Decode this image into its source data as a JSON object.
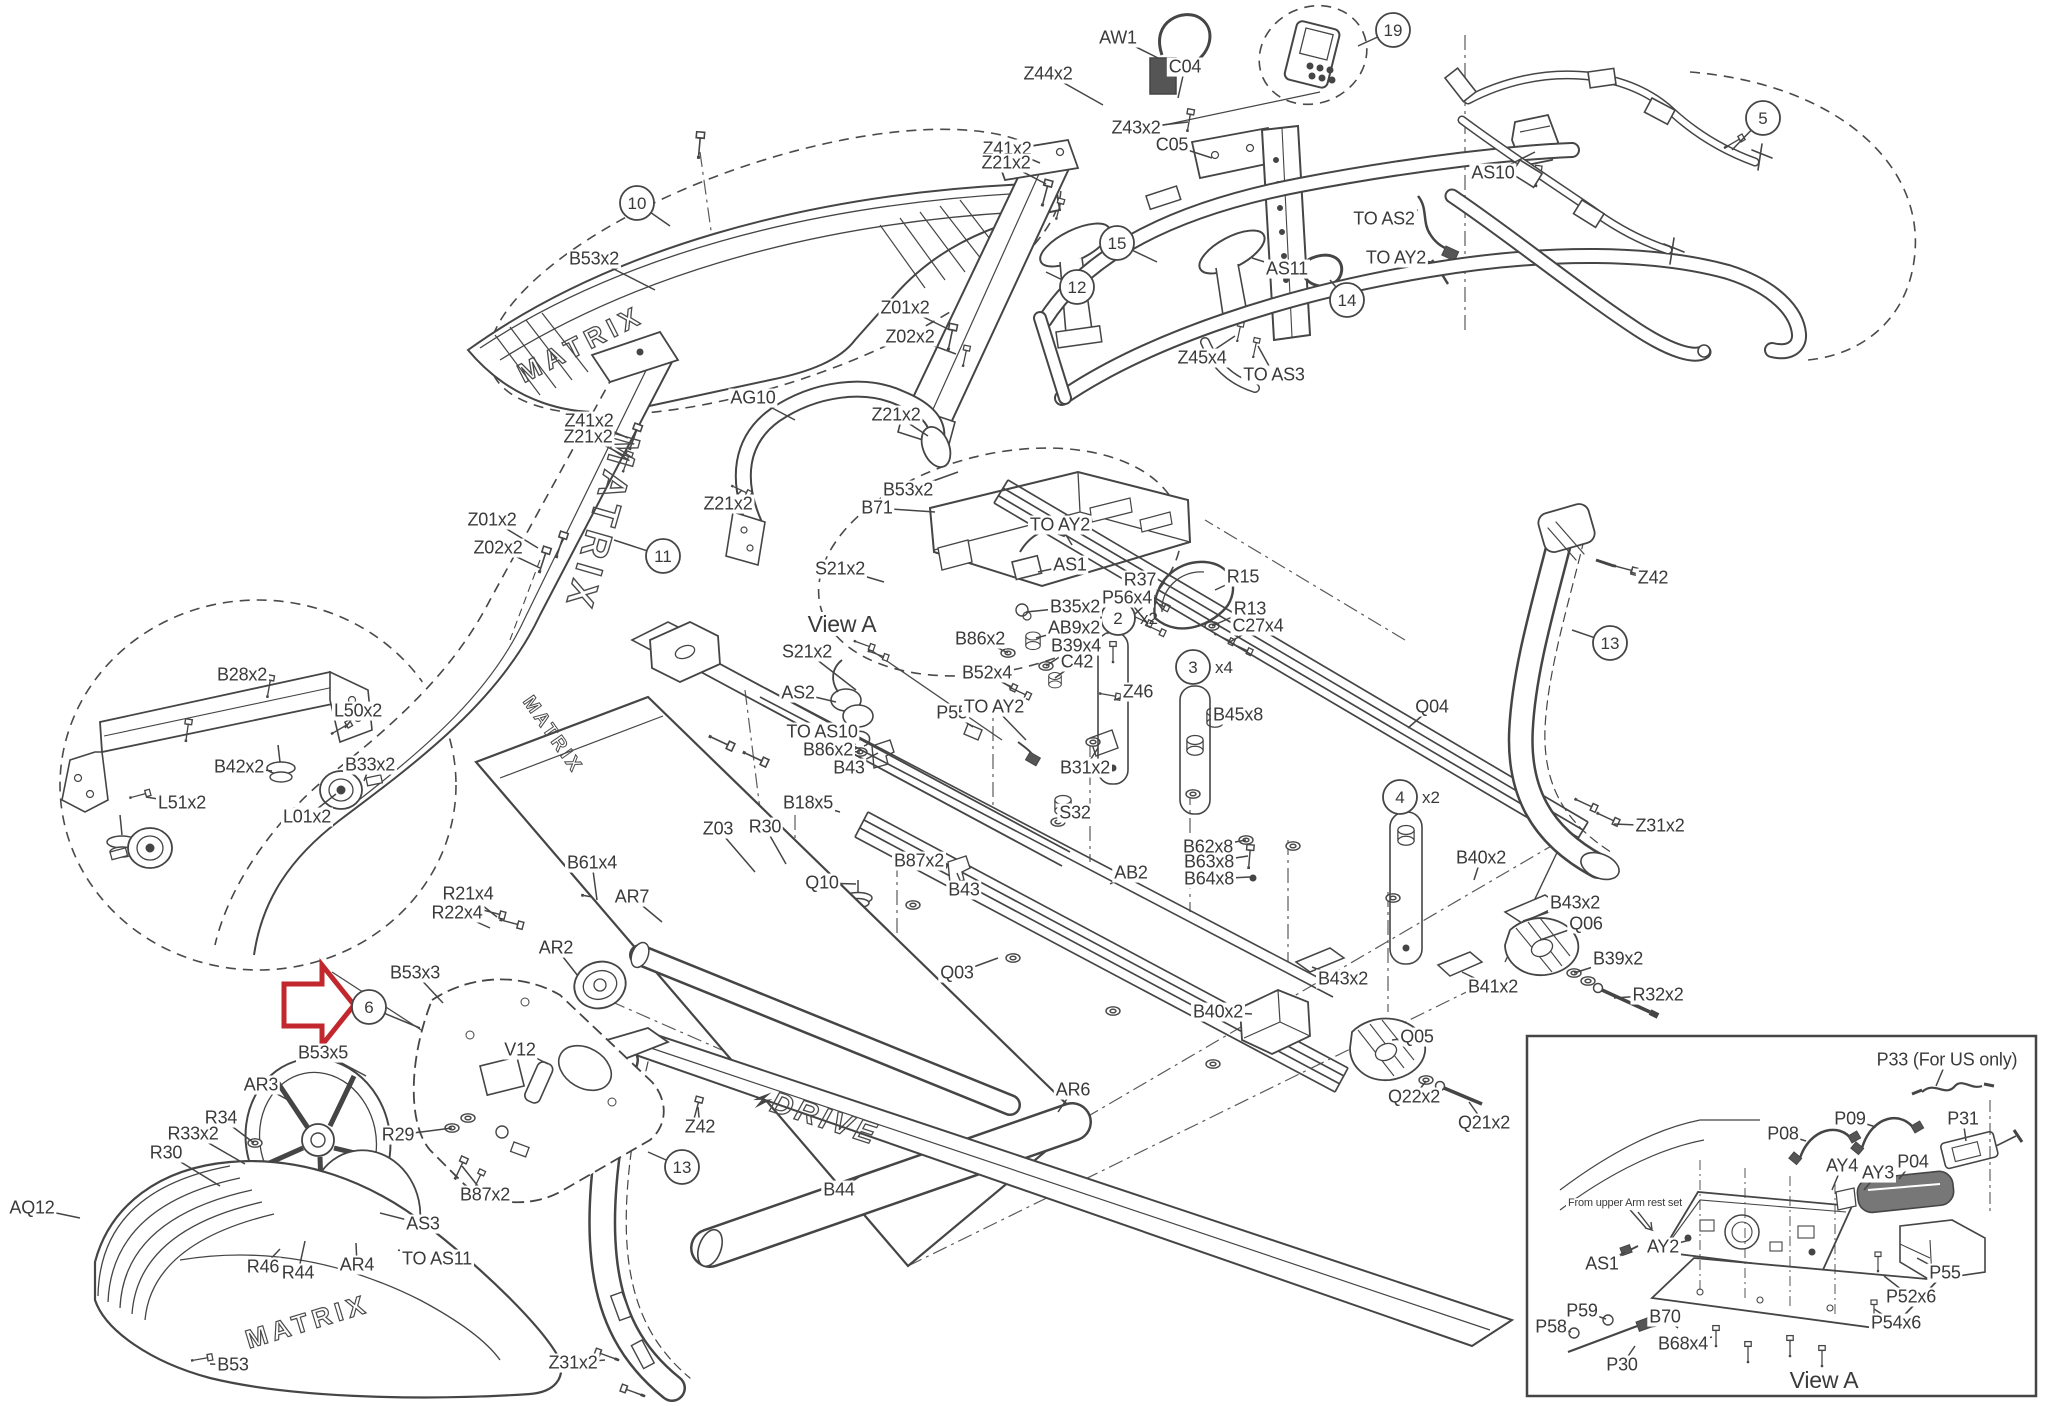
{
  "meta": {
    "page_type": "exploded-parts-diagram",
    "background": "#ffffff",
    "line_color": "#454545",
    "label_color": "#3a3a3a",
    "label_font_px": 18
  },
  "logos": {
    "brand": "MATRIX",
    "drive": "DRIVE"
  },
  "arrow": {
    "color": "#c1272d",
    "points_at_callout": "6"
  },
  "inset": {
    "title": "View A"
  },
  "labels": [
    {
      "t": "AW1",
      "x": 1118,
      "y": 38,
      "l": [
        1158,
        58
      ]
    },
    {
      "t": "C04",
      "x": 1185,
      "y": 67,
      "l": [
        1178,
        98
      ]
    },
    {
      "t": "Z44x2",
      "x": 1048,
      "y": 74,
      "l": [
        1103,
        105
      ]
    },
    {
      "t": "Z43x2",
      "x": 1136,
      "y": 128,
      "l": [
        1188,
        122
      ]
    },
    {
      "t": "C05",
      "x": 1172,
      "y": 145,
      "l": [
        1212,
        158
      ]
    },
    {
      "t": "AS10",
      "x": 1493,
      "y": 173,
      "l": [
        1535,
        152
      ]
    },
    {
      "t": "TO AS2",
      "x": 1384,
      "y": 219,
      "l": [
        1418,
        210
      ]
    },
    {
      "t": "TO AY2",
      "x": 1396,
      "y": 258,
      "l": [
        1432,
        262
      ]
    },
    {
      "t": "AS11",
      "x": 1287,
      "y": 269,
      "l": [
        1252,
        258
      ]
    },
    {
      "t": "Z45x4",
      "x": 1202,
      "y": 358,
      "l": [
        1235,
        336
      ]
    },
    {
      "t": "TO AS3",
      "x": 1274,
      "y": 375,
      "l": [
        1258,
        346
      ]
    },
    {
      "t": "B53x2",
      "x": 594,
      "y": 259,
      "l": [
        655,
        290
      ]
    },
    {
      "t": "Z41x2",
      "x": 1007,
      "y": 149,
      "l": [
        1040,
        163
      ]
    },
    {
      "t": "Z21x2",
      "x": 1006,
      "y": 163,
      "l": [
        1046,
        184
      ]
    },
    {
      "t": "Z01x2",
      "x": 905,
      "y": 308,
      "l": [
        950,
        330
      ]
    },
    {
      "t": "Z02x2",
      "x": 910,
      "y": 337,
      "l": [
        956,
        354
      ]
    },
    {
      "t": "AG10",
      "x": 753,
      "y": 398,
      "l": [
        795,
        420
      ]
    },
    {
      "t": "Z21x2",
      "x": 896,
      "y": 415,
      "l": [
        928,
        436
      ]
    },
    {
      "t": "Z41x2",
      "x": 589,
      "y": 421,
      "l": [
        628,
        438
      ]
    },
    {
      "t": "Z21x2",
      "x": 588,
      "y": 437,
      "l": [
        625,
        456
      ]
    },
    {
      "t": "Z21x2",
      "x": 728,
      "y": 504,
      "l": [
        742,
        490
      ]
    },
    {
      "t": "Z01x2",
      "x": 492,
      "y": 520,
      "l": [
        538,
        548
      ]
    },
    {
      "t": "Z02x2",
      "x": 498,
      "y": 548,
      "l": [
        540,
        568
      ]
    },
    {
      "t": "B53x2",
      "x": 908,
      "y": 490,
      "l": [
        958,
        472
      ]
    },
    {
      "t": "B71",
      "x": 877,
      "y": 508,
      "l": [
        935,
        512
      ]
    },
    {
      "t": "S21x2",
      "x": 840,
      "y": 569,
      "l": [
        884,
        582
      ]
    },
    {
      "t": "View A",
      "x": 842,
      "y": 624,
      "s": 23
    },
    {
      "t": "S21x2",
      "x": 807,
      "y": 652,
      "l": [
        856,
        690
      ]
    },
    {
      "t": "B86x2",
      "x": 980,
      "y": 639,
      "l": [
        1008,
        653
      ]
    },
    {
      "t": "B52x4",
      "x": 987,
      "y": 673,
      "l": [
        1012,
        688
      ]
    },
    {
      "t": "TO AY2",
      "x": 1060,
      "y": 525,
      "l": [
        1072,
        545
      ]
    },
    {
      "t": "AS1",
      "x": 1070,
      "y": 565,
      "l": [
        1038,
        572
      ]
    },
    {
      "t": "B35x2",
      "x": 1075,
      "y": 607,
      "l": [
        1026,
        612
      ]
    },
    {
      "t": "AB9x2",
      "x": 1074,
      "y": 628,
      "l": [
        1036,
        638
      ]
    },
    {
      "t": "B39x4",
      "x": 1076,
      "y": 646,
      "l": [
        1046,
        666
      ]
    },
    {
      "t": "C42",
      "x": 1077,
      "y": 662,
      "l": [
        1055,
        678
      ]
    },
    {
      "t": "R37",
      "x": 1140,
      "y": 580,
      "l": [
        1163,
        610
      ]
    },
    {
      "t": "R15",
      "x": 1243,
      "y": 577,
      "l": [
        1215,
        590
      ]
    },
    {
      "t": "P56x4",
      "x": 1127,
      "y": 598,
      "l": [
        1148,
        624
      ]
    },
    {
      "t": "R13",
      "x": 1250,
      "y": 609,
      "l": [
        1212,
        626
      ]
    },
    {
      "t": "C27x4",
      "x": 1258,
      "y": 626,
      "l": [
        1228,
        643
      ]
    },
    {
      "t": "Z46",
      "x": 1138,
      "y": 692,
      "l": [
        1114,
        700
      ]
    },
    {
      "t": "P55",
      "x": 952,
      "y": 713,
      "l": [
        973,
        727
      ]
    },
    {
      "t": "TO AY2",
      "x": 994,
      "y": 707,
      "l": [
        1026,
        740
      ]
    },
    {
      "t": "B45x8",
      "x": 1238,
      "y": 715,
      "l": [
        1215,
        719
      ]
    },
    {
      "t": "B31x2",
      "x": 1085,
      "y": 768,
      "l": [
        1098,
        748
      ]
    },
    {
      "t": "S32",
      "x": 1075,
      "y": 813,
      "l": [
        1058,
        822
      ]
    },
    {
      "t": "B18x5",
      "x": 808,
      "y": 803,
      "l": [
        840,
        812
      ]
    },
    {
      "t": "AS2",
      "x": 798,
      "y": 693,
      "l": [
        836,
        702
      ]
    },
    {
      "t": "TO AS10",
      "x": 822,
      "y": 732,
      "l": [
        860,
        740
      ]
    },
    {
      "t": "B86x2",
      "x": 828,
      "y": 750,
      "l": [
        860,
        752
      ]
    },
    {
      "t": "B43",
      "x": 849,
      "y": 768,
      "l": [
        878,
        753
      ]
    },
    {
      "t": "Z03",
      "x": 718,
      "y": 829,
      "l": [
        755,
        872
      ]
    },
    {
      "t": "R30",
      "x": 765,
      "y": 827,
      "l": [
        786,
        864
      ]
    },
    {
      "t": "B61x4",
      "x": 592,
      "y": 863,
      "l": [
        597,
        900
      ]
    },
    {
      "t": "AR7",
      "x": 632,
      "y": 897,
      "l": [
        662,
        922
      ]
    },
    {
      "t": "R21x4",
      "x": 468,
      "y": 894,
      "l": [
        497,
        917
      ]
    },
    {
      "t": "R22x4",
      "x": 457,
      "y": 913,
      "l": [
        490,
        928
      ]
    },
    {
      "t": "Q10",
      "x": 822,
      "y": 883,
      "l": [
        856,
        884
      ]
    },
    {
      "t": "B87x2",
      "x": 919,
      "y": 861,
      "l": [
        940,
        867
      ]
    },
    {
      "t": "B43",
      "x": 964,
      "y": 890,
      "l": [
        957,
        873
      ]
    },
    {
      "t": "AB2",
      "x": 1131,
      "y": 873,
      "l": [
        1110,
        884
      ]
    },
    {
      "t": "B62x8",
      "x": 1208,
      "y": 847,
      "l": [
        1246,
        840
      ]
    },
    {
      "t": "B63x8",
      "x": 1209,
      "y": 862,
      "l": [
        1248,
        856
      ]
    },
    {
      "t": "B64x8",
      "x": 1209,
      "y": 879,
      "l": [
        1250,
        877
      ]
    },
    {
      "t": "Q03",
      "x": 957,
      "y": 973,
      "l": [
        998,
        958
      ]
    },
    {
      "t": "B40x2",
      "x": 1218,
      "y": 1012,
      "l": [
        1252,
        1014
      ]
    },
    {
      "t": "AR6",
      "x": 1073,
      "y": 1090,
      "l": [
        1058,
        1112
      ]
    },
    {
      "t": "Q05",
      "x": 1417,
      "y": 1037,
      "l": [
        1392,
        1040
      ]
    },
    {
      "t": "Q22x2",
      "x": 1414,
      "y": 1097,
      "l": [
        1426,
        1081
      ]
    },
    {
      "t": "Q21x2",
      "x": 1484,
      "y": 1123,
      "l": [
        1469,
        1102
      ]
    },
    {
      "t": "Z31x2",
      "x": 1660,
      "y": 826,
      "l": [
        1614,
        824
      ]
    },
    {
      "t": "B40x2",
      "x": 1481,
      "y": 858,
      "l": [
        1474,
        880
      ]
    },
    {
      "t": "B43x2",
      "x": 1575,
      "y": 903,
      "l": [
        1523,
        921
      ]
    },
    {
      "t": "Q06",
      "x": 1586,
      "y": 924,
      "l": [
        1540,
        940
      ]
    },
    {
      "t": "B39x2",
      "x": 1618,
      "y": 959,
      "l": [
        1574,
        973
      ]
    },
    {
      "t": "R32x2",
      "x": 1658,
      "y": 995,
      "l": [
        1614,
        998
      ]
    },
    {
      "t": "B41x2",
      "x": 1493,
      "y": 987,
      "l": [
        1462,
        972
      ]
    },
    {
      "t": "B43x2",
      "x": 1343,
      "y": 979,
      "l": [
        1312,
        967
      ]
    },
    {
      "t": "Q04",
      "x": 1432,
      "y": 707,
      "l": [
        1408,
        728
      ]
    },
    {
      "t": "Z42",
      "x": 1653,
      "y": 578,
      "l": [
        1630,
        572
      ]
    },
    {
      "t": "Z42",
      "x": 700,
      "y": 1127,
      "l": [
        698,
        1107
      ]
    },
    {
      "t": "B44",
      "x": 839,
      "y": 1190,
      "l": [
        862,
        1175
      ]
    },
    {
      "t": "Z31x2",
      "x": 573,
      "y": 1363,
      "l": [
        605,
        1360
      ]
    },
    {
      "t": "AR2",
      "x": 556,
      "y": 948,
      "l": [
        578,
        976
      ]
    },
    {
      "t": "B53x3",
      "x": 415,
      "y": 973,
      "l": [
        443,
        1003
      ]
    },
    {
      "t": "B53x5",
      "x": 323,
      "y": 1053,
      "l": [
        366,
        1076
      ]
    },
    {
      "t": "V12",
      "x": 520,
      "y": 1050,
      "l": [
        548,
        1064
      ]
    },
    {
      "t": "R29",
      "x": 398,
      "y": 1135,
      "l": [
        452,
        1128
      ]
    },
    {
      "t": "B87x2",
      "x": 485,
      "y": 1195,
      "l": [
        462,
        1166
      ]
    },
    {
      "t": "AR3",
      "x": 261,
      "y": 1085,
      "l": [
        288,
        1100
      ]
    },
    {
      "t": "R34",
      "x": 221,
      "y": 1118,
      "l": [
        254,
        1143
      ]
    },
    {
      "t": "R33x2",
      "x": 193,
      "y": 1134,
      "l": [
        245,
        1164
      ]
    },
    {
      "t": "R30",
      "x": 166,
      "y": 1153,
      "l": [
        220,
        1186
      ]
    },
    {
      "t": "AQ12",
      "x": 32,
      "y": 1208,
      "l": [
        80,
        1218
      ]
    },
    {
      "t": "R46",
      "x": 263,
      "y": 1267,
      "l": [
        280,
        1249
      ]
    },
    {
      "t": "R44",
      "x": 298,
      "y": 1273,
      "l": [
        305,
        1241
      ]
    },
    {
      "t": "AR4",
      "x": 357,
      "y": 1265,
      "l": [
        356,
        1243
      ]
    },
    {
      "t": "AS3",
      "x": 423,
      "y": 1224,
      "l": [
        380,
        1213
      ]
    },
    {
      "t": "TO AS11",
      "x": 437,
      "y": 1259,
      "l": [
        398,
        1250
      ]
    },
    {
      "t": "B53",
      "x": 233,
      "y": 1365,
      "l": [
        210,
        1364
      ]
    },
    {
      "t": "B28x2",
      "x": 242,
      "y": 675,
      "l": [
        270,
        685
      ]
    },
    {
      "t": "L50x2",
      "x": 358,
      "y": 711,
      "l": [
        345,
        728
      ]
    },
    {
      "t": "B42x2",
      "x": 239,
      "y": 767,
      "l": [
        272,
        771
      ]
    },
    {
      "t": "B33x2",
      "x": 370,
      "y": 765,
      "l": [
        364,
        781
      ]
    },
    {
      "t": "L51x2",
      "x": 182,
      "y": 803,
      "l": [
        146,
        797
      ]
    },
    {
      "t": "L01x2",
      "x": 307,
      "y": 817,
      "l": [
        336,
        794
      ]
    },
    {
      "t": "P33 (For US only)",
      "x": 1947,
      "y": 1060,
      "l": [
        1936,
        1086
      ]
    },
    {
      "t": "P09",
      "x": 1850,
      "y": 1119,
      "l": [
        1876,
        1127
      ]
    },
    {
      "t": "P08",
      "x": 1783,
      "y": 1134,
      "l": [
        1806,
        1141
      ]
    },
    {
      "t": "P31",
      "x": 1963,
      "y": 1119,
      "l": [
        1966,
        1141
      ]
    },
    {
      "t": "P04",
      "x": 1913,
      "y": 1162,
      "l": [
        1899,
        1179
      ]
    },
    {
      "t": "AY4",
      "x": 1842,
      "y": 1166,
      "l": [
        1832,
        1190
      ]
    },
    {
      "t": "AY3",
      "x": 1878,
      "y": 1173,
      "l": [
        1864,
        1190
      ]
    },
    {
      "t": "From upper Arm rest set",
      "x": 1625,
      "y": 1204,
      "s": 11,
      "l": [
        1646,
        1228
      ]
    },
    {
      "t": "AY2",
      "x": 1663,
      "y": 1247,
      "l": [
        1690,
        1240
      ]
    },
    {
      "t": "AS1",
      "x": 1602,
      "y": 1264,
      "l": [
        1625,
        1252
      ]
    },
    {
      "t": "P55",
      "x": 1945,
      "y": 1273,
      "l": [
        1917,
        1258
      ]
    },
    {
      "t": "P52x6",
      "x": 1911,
      "y": 1297,
      "l": [
        1884,
        1276
      ]
    },
    {
      "t": "P54x6",
      "x": 1896,
      "y": 1323,
      "l": [
        1874,
        1309
      ]
    },
    {
      "t": "P59",
      "x": 1582,
      "y": 1311,
      "l": [
        1606,
        1319
      ]
    },
    {
      "t": "P58",
      "x": 1551,
      "y": 1327,
      "l": [
        1571,
        1332
      ]
    },
    {
      "t": "B70",
      "x": 1665,
      "y": 1317,
      "l": [
        1678,
        1328
      ]
    },
    {
      "t": "B68x4",
      "x": 1683,
      "y": 1344,
      "l": [
        1712,
        1337
      ]
    },
    {
      "t": "P30",
      "x": 1622,
      "y": 1365,
      "l": [
        1635,
        1346
      ]
    },
    {
      "t": "View A",
      "x": 1824,
      "y": 1380,
      "s": 23
    }
  ],
  "callouts": [
    {
      "n": "10",
      "x": 637,
      "y": 203,
      "l": [
        670,
        226
      ]
    },
    {
      "n": "11",
      "x": 663,
      "y": 556,
      "l": [
        614,
        540
      ]
    },
    {
      "n": "12",
      "x": 1077,
      "y": 287,
      "l": [
        1046,
        272
      ]
    },
    {
      "n": "19",
      "x": 1393,
      "y": 30,
      "l": [
        1358,
        46
      ]
    },
    {
      "n": "15",
      "x": 1117,
      "y": 243,
      "l": [
        1157,
        262
      ]
    },
    {
      "n": "14",
      "x": 1347,
      "y": 300,
      "l": [
        1330,
        280
      ]
    },
    {
      "n": "5",
      "x": 1763,
      "y": 118,
      "l": [
        1732,
        150
      ]
    },
    {
      "n": "2",
      "x": 1118,
      "y": 618,
      "suffix": "x2"
    },
    {
      "n": "3",
      "x": 1193,
      "y": 667,
      "suffix": "x4"
    },
    {
      "n": "4",
      "x": 1400,
      "y": 797,
      "suffix": "x2"
    },
    {
      "n": "6",
      "x": 369,
      "y": 1007,
      "l": [
        420,
        1028
      ]
    },
    {
      "n": "13",
      "x": 682,
      "y": 1167,
      "l": [
        648,
        1152
      ]
    },
    {
      "n": "13",
      "x": 1610,
      "y": 643,
      "l": [
        1572,
        630
      ]
    }
  ]
}
